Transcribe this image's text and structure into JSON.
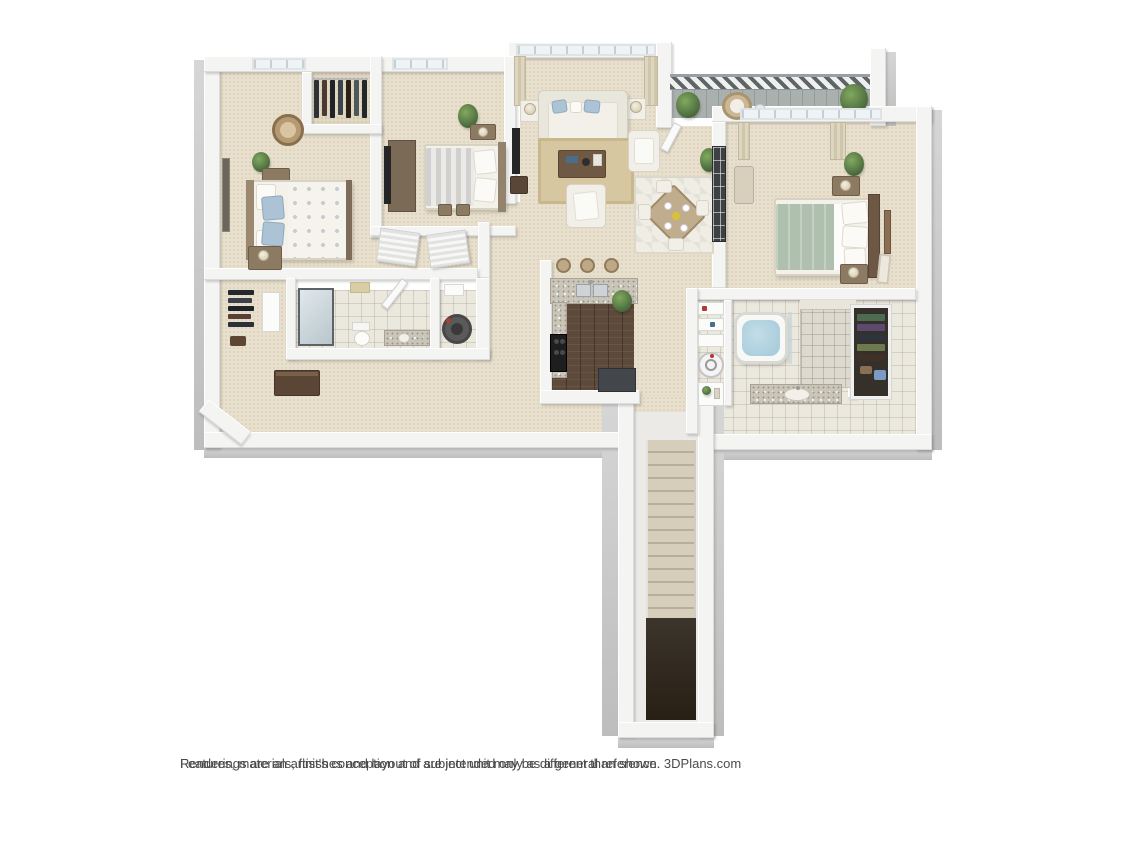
{
  "page": {
    "background": "#ffffff"
  },
  "disclaimer": {
    "line1": "Renderings are an artist's conception and are intended only as a general reference.",
    "line2": "Features, materials, finishes and layout of subject unit may be different than shown. 3DPlans.com"
  },
  "floorplan": {
    "type": "3d-dollhouse-floor-plan",
    "view": "top-down rendered apartment unit with entry staircase",
    "rooms": [
      {
        "name": "Bedroom 2",
        "features": [
          "bed with blue pillows and floral duvet",
          "two nightstands with lamp and plant",
          "wicker chair",
          "leaning mirror",
          "window"
        ]
      },
      {
        "name": "Walk-in Closet",
        "features": [
          "hanging clothes rod"
        ]
      },
      {
        "name": "Bedroom 3",
        "features": [
          "bed with striped blanket",
          "dresser with TV",
          "nightstand",
          "plant",
          "louvered closet doors",
          "storage boxes"
        ]
      },
      {
        "name": "Living Room",
        "features": [
          "picture window with curtains",
          "sofa with accent pillows",
          "end tables with lamps",
          "coffee table",
          "sisal rug",
          "two armchairs",
          "TV and console"
        ]
      },
      {
        "name": "Dining Area",
        "features": [
          "square table with four place settings",
          "four chairs",
          "patterned rug",
          "potted plants"
        ]
      },
      {
        "name": "Balcony",
        "features": [
          "slatted railing",
          "two potted plants",
          "round lounge chair",
          "side table",
          "door to dining area"
        ]
      },
      {
        "name": "Master Bedroom",
        "features": [
          "bed with sage green duvet",
          "dark wood headboard",
          "two nightstands with lamps",
          "bench",
          "plant",
          "gridded glass panel",
          "windows with curtains",
          "wall art",
          "leaning frame"
        ]
      },
      {
        "name": "Master Bathroom",
        "features": [
          "soaking tub",
          "glass panel",
          "tiled shower",
          "granite vanity with sink",
          "linen shelves",
          "washer",
          "wardrobe with hanging clothes"
        ]
      },
      {
        "name": "Hall Bathroom",
        "features": [
          "glass shower",
          "toilet",
          "granite vanity",
          "ceiling light",
          "open door"
        ]
      },
      {
        "name": "Hall Closet",
        "features": [
          "hanging clothes",
          "shelving"
        ]
      },
      {
        "name": "Utility Closet",
        "features": [
          "water heater",
          "shelf"
        ]
      },
      {
        "name": "Kitchen",
        "features": [
          "granite breakfast bar",
          "three bar stools",
          "double stainless sink",
          "black range",
          "dark counter",
          "wood floor",
          "plant"
        ]
      },
      {
        "name": "Hallway",
        "features": [
          "credenza"
        ]
      },
      {
        "name": "Entry Stairs",
        "features": [
          "carpeted landing",
          "staircase descending to entry",
          "dark lower landing"
        ]
      }
    ],
    "colors": {
      "background": "#ffffff",
      "wall": "#f4f4f3",
      "wallFace": "#c9c9c9",
      "carpet": "#e8e0cc",
      "carpetDark": "#e0d7c1",
      "tile": "#ebe8de",
      "wood": "#5e4a3a",
      "granite": "#c9c5b8",
      "rug": "#d6c7a1",
      "diningRug": "#efede4",
      "sofa": "#f2f0e9",
      "pillowBlue": "#abc3d4",
      "blanketSage": "#b0c0af",
      "bedStripe": "#d0d0d0",
      "water": "#a4c9d8",
      "plant": "#46663a",
      "railing": "#5f6567",
      "stairTread": "#d6cebb",
      "stairShadow": "#b7af9b",
      "stairLanding": "#3c352b",
      "furnWood": "#8d7a62",
      "furnDark": "#5b4636",
      "tv": "#262626",
      "counterDark": "#43464a",
      "textGray": "#4b4b4b"
    }
  }
}
